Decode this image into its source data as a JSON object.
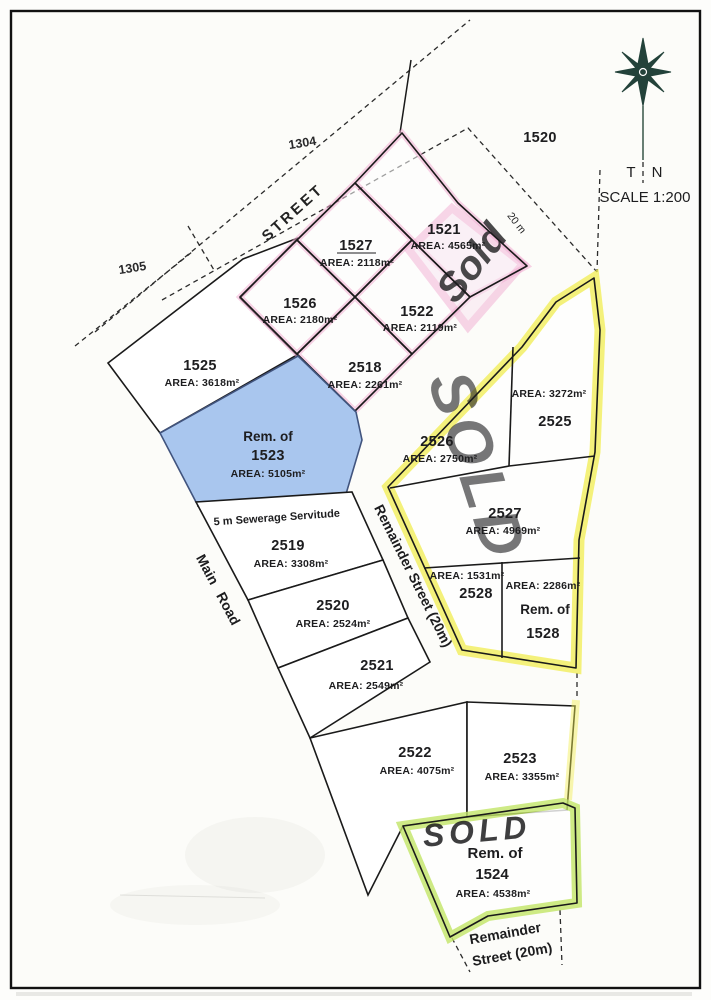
{
  "compass": {
    "t": "T",
    "n": "N",
    "scale": "SCALE 1:200"
  },
  "streets": {
    "street_top": "STREET",
    "width_20m": "20 m",
    "servitude": "5 m Sewerage Servitude",
    "main_road": "Main Road",
    "remainder_mid": "Remainder Street (20m)",
    "remainder_bottom_1": "Remainder",
    "remainder_bottom_2": "Street (20m)"
  },
  "adjacent": {
    "p1304": "1304",
    "p1305": "1305",
    "p1520": "1520"
  },
  "sold": {
    "pink": "Sold",
    "yellow": "SOLD",
    "green": "SOLD"
  },
  "lots": {
    "l1527": {
      "number": "1527",
      "area": "AREA: 2118m²"
    },
    "l1526": {
      "number": "1526",
      "area": "AREA: 2180m²"
    },
    "l1522": {
      "number": "1522",
      "area": "AREA: 2119m²"
    },
    "l2518": {
      "number": "2518",
      "area": "AREA: 2261m²"
    },
    "l1521": {
      "number": "1521",
      "area": "AREA: 4565m²"
    },
    "l1525": {
      "number": "1525",
      "area": "AREA: 3618m²"
    },
    "l1523": {
      "prefix": "Rem. of",
      "number": "1523",
      "area": "AREA: 5105m²"
    },
    "l2525": {
      "number": "2525",
      "area": "AREA: 3272m²"
    },
    "l2526": {
      "number": "2526",
      "area": "AREA: 2750m²"
    },
    "l2527": {
      "number": "2527",
      "area": "AREA: 4969m²"
    },
    "l2528": {
      "number": "2528",
      "area": "AREA: 1531m²"
    },
    "l1528": {
      "prefix": "Rem. of",
      "number": "1528",
      "area": "AREA: 2286m²"
    },
    "l2519": {
      "number": "2519",
      "area": "AREA: 3308m²"
    },
    "l2520": {
      "number": "2520",
      "area": "AREA: 2524m²"
    },
    "l2521": {
      "number": "2521",
      "area": "AREA: 2549m²"
    },
    "l2522": {
      "number": "2522",
      "area": "AREA: 4075m²"
    },
    "l2523": {
      "number": "2523",
      "area": "AREA: 3355m²"
    },
    "l1524": {
      "prefix": "Rem. of",
      "number": "1524",
      "area": "AREA: 4538m²"
    }
  },
  "colors": {
    "pink_highlight": "#f2aed3",
    "pink_fill": "#f9e4f1",
    "pink_text": "#ef8cc4",
    "blue_fill": "#a9c6ee",
    "blue_stroke": "#41547e",
    "blue_text": "#1b2f7a",
    "yellow_highlight": "#f2ee52",
    "yellow_text": "#ece23e",
    "green_highlight": "#c3e668",
    "green_text": "#a8d348",
    "ink": "#1d1d1f"
  }
}
